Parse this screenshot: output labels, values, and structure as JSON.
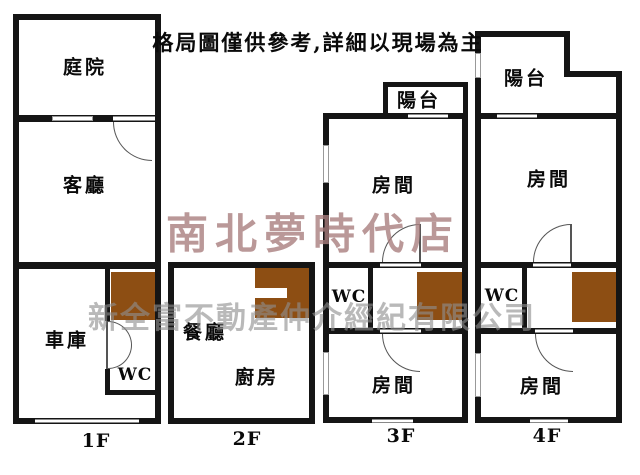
{
  "disclaimer": "格局圖僅供參考,詳細以現場為主",
  "watermark": {
    "store": "南北夢時代店",
    "company": "新全富不動產仲介經紀有限公司"
  },
  "colors": {
    "wall": "#151515",
    "stairs": "#8d4e13",
    "door": "#555555",
    "store": "#a97f7f",
    "company": "#8f8f8f"
  },
  "floors": {
    "f1": {
      "label": "1F",
      "rooms": {
        "courtyard": "庭院",
        "living": "客廳",
        "garage": "車庫",
        "wc": "WC"
      }
    },
    "f2": {
      "label": "2F",
      "rooms": {
        "dining": "餐廳",
        "kitchen": "廚房"
      }
    },
    "f3": {
      "label": "3F",
      "rooms": {
        "balcony": "陽台",
        "room_top": "房間",
        "wc": "WC",
        "room_bottom": "房間"
      }
    },
    "f4": {
      "label": "4F",
      "rooms": {
        "balcony": "陽台",
        "room_top": "房間",
        "wc": "WC",
        "room_bottom": "房間"
      }
    }
  }
}
